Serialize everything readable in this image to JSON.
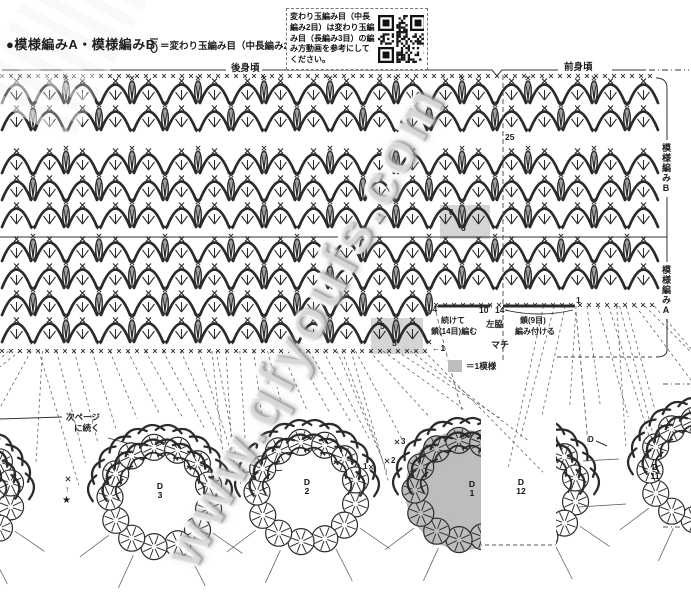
{
  "header": {
    "title": "●模様編みA・模様編みB",
    "legend_text": "＝変わり玉編み目（中長編み2目）"
  },
  "note_box": {
    "lines": [
      "変わり玉編み目（中長",
      "編み2目）は変わり玉編",
      "み目（長編み3目）の編",
      "み方動画を参考にして",
      "ください。"
    ]
  },
  "braces": {
    "back": "後身頃",
    "front": "前身頃"
  },
  "side_labels": {
    "pattern_b": "模様編みB",
    "pattern_a": "模様編みA"
  },
  "row_numbers": {
    "r25": "25",
    "r6_top": "6",
    "r6_bottom": "6",
    "r5_top": "5",
    "r5_bottom": "5",
    "r1_left": "←1",
    "r1_right": "1",
    "r4": "→4",
    "n10": "10",
    "n14": "14",
    "up_arrow": "↑"
  },
  "annotations": {
    "continue_line1": "続けて",
    "continue_line2": "鎖(14目)編む",
    "left_side": "左脇",
    "attach_line1": "鎖(9目)",
    "attach_line2": "編み付ける",
    "gusset": "マチ",
    "swatch": "＝1模様",
    "next_page_line1": "次ページ",
    "next_page_line2": "に続く",
    "d_marker": "D",
    "star": "★",
    "up_arrow": "↑"
  },
  "join_numbers": {
    "n1": "1",
    "n2": "2",
    "n3": "3"
  },
  "motif_labels": [
    {
      "letter": "D",
      "number": "3"
    },
    {
      "letter": "D",
      "number": "2"
    },
    {
      "letter": "D",
      "number": "1"
    },
    {
      "letter": "D",
      "number": "12"
    },
    {
      "letter": "D",
      "number": "11"
    }
  ],
  "watermark": "www.qfyoufs.com",
  "colors": {
    "ink": "#2b2b2b",
    "gray": "#bdbdbd",
    "shade": "#cbcbcb",
    "guide": "#666666"
  },
  "diagram": {
    "unit": 33,
    "top_chain_y": 76,
    "separator_y": 237,
    "dashed_vline_x": 503,
    "bands": [
      {
        "y": 106,
        "x0": 0,
        "x1": 660,
        "phase": 0
      },
      {
        "y": 133,
        "x0": 0,
        "x1": 660,
        "phase": 1
      },
      {
        "y": 176,
        "x0": 0,
        "x1": 660,
        "phase": 0
      },
      {
        "y": 203,
        "x0": 0,
        "x1": 660,
        "phase": 1
      },
      {
        "y": 230,
        "x0": 0,
        "x1": 660,
        "phase": 0
      },
      {
        "y": 264,
        "x0": 0,
        "x1": 660,
        "phase": 1
      },
      {
        "y": 291,
        "x0": 0,
        "x1": 660,
        "phase": 0
      },
      {
        "y": 318,
        "x0": 0,
        "x1": 433,
        "phase": 1
      },
      {
        "y": 345,
        "x0": 0,
        "x1": 433,
        "phase": 0
      }
    ],
    "bottom_chain_left": {
      "y": 351,
      "x0": 2,
      "x1": 432
    },
    "bottom_chain_right": {
      "y": 305,
      "x0": 436,
      "x1": 658
    },
    "gray_rects": [
      [
        440,
        205,
        50,
        34
      ],
      [
        371,
        318,
        52,
        36
      ]
    ],
    "motifs": [
      {
        "cx": -38,
        "cy": 495,
        "gray": false
      },
      {
        "cx": 160,
        "cy": 497,
        "gray": false
      },
      {
        "cx": 307,
        "cy": 492,
        "gray": false
      },
      {
        "cx": 465,
        "cy": 490,
        "gray": true,
        "clip": [
          0,
          481
        ]
      },
      {
        "cx": 527,
        "cy": 490,
        "gray": false,
        "clip": [
          556,
          691
        ]
      },
      {
        "cx": 700,
        "cy": 470,
        "gray": false
      }
    ]
  }
}
